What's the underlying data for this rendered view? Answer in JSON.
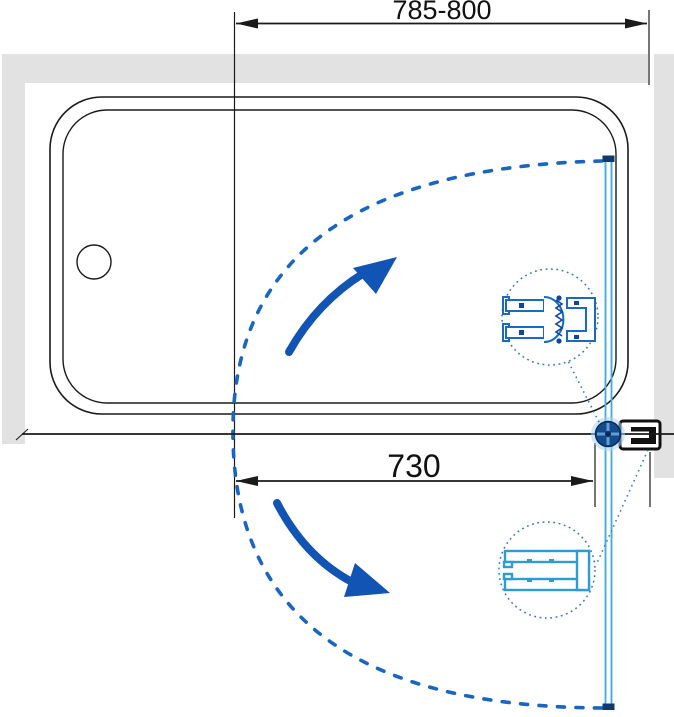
{
  "diagram": {
    "type": "bath-screen-installation-plan",
    "dimensions": {
      "overall_width_range": {
        "label": "785-800"
      },
      "door_width": {
        "label": "730"
      }
    },
    "parts": {
      "bathtub": "bathtub-top-view",
      "glass_panel": "swing-glass-panel",
      "hinge": "wall-pivot-hinge",
      "wall_bracket": "wall-mount-profile",
      "detail_top": "magnetic-closure-profile-detail",
      "detail_bottom": "glass-edge-profile-detail",
      "swing_path": "door-swing-arc"
    },
    "colors": {
      "accent_blue": "#1254b4",
      "dash_blue": "#1866c2",
      "glass_blue": "#46aed8",
      "navy": "#0e3a70",
      "detail_blue": "#3577bd",
      "magnet_profile_blue": "#1a6ac1",
      "magnet_profile_dark": "#0d47a1",
      "glass_profile_cyan": "#2d9bd4",
      "wall_gray": "#e2e2e2",
      "line_black": "#1a1a1a"
    }
  }
}
